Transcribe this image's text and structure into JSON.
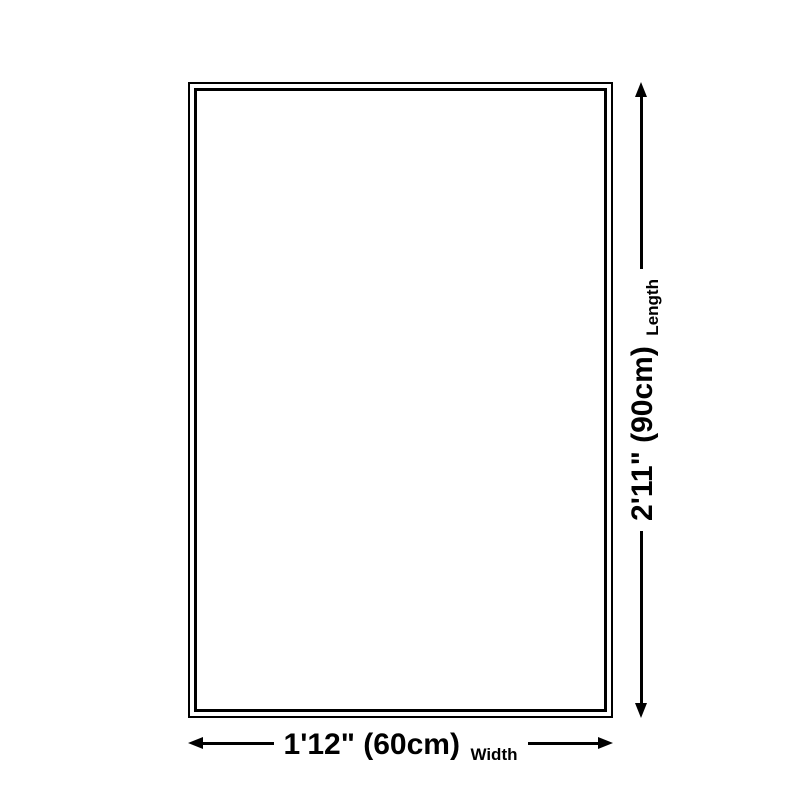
{
  "diagram": {
    "background_color": "#ffffff",
    "line_color": "#000000",
    "shape": "rug-outline-rectangle",
    "dimensions": {
      "width": {
        "value": "1'12\" (60cm)",
        "label": "Width"
      },
      "length": {
        "value": "2'11\" (90cm)",
        "label": "Length"
      }
    }
  }
}
